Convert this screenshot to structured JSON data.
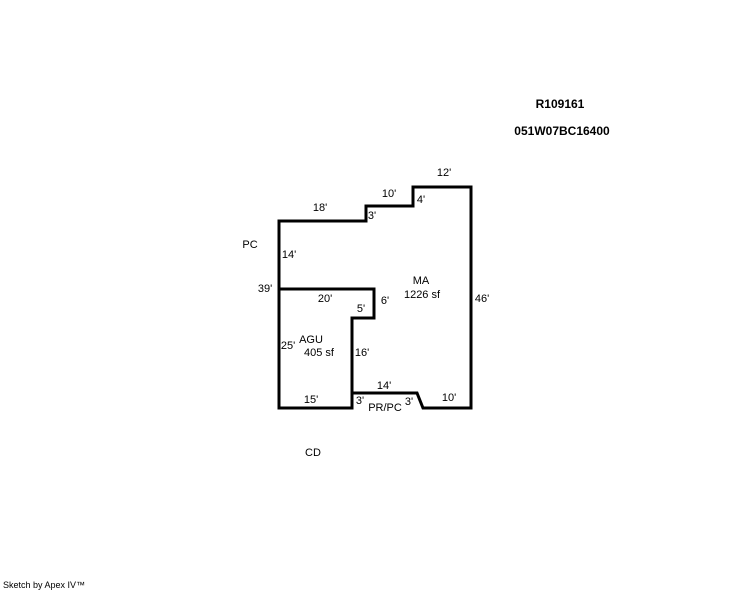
{
  "header": {
    "record_id": "R109161",
    "parcel_id": "051W07BC16400"
  },
  "footer": {
    "branding": "Sketch by Apex IV™"
  },
  "sketch": {
    "areas": [
      {
        "code": "MA",
        "size": "1226 sf"
      },
      {
        "code": "AGU",
        "size": "405 sf"
      }
    ],
    "zone_labels": {
      "pc": "PC",
      "prpc": "PR/PC",
      "cd": "CD"
    },
    "dimensions": {
      "top_12": "12'",
      "top_10": "10'",
      "top_4": "4'",
      "top_18": "18'",
      "top_3": "3'",
      "left_14": "14'",
      "left_39": "39'",
      "left_25": "25'",
      "right_46": "46'",
      "mid_20": "20'",
      "mid_6": "6'",
      "mid_5": "5'",
      "mid_16": "16'",
      "bottom_14": "14'",
      "bottom_15": "15'",
      "bottom_3_left": "3'",
      "bottom_3_right": "3'",
      "bottom_10": "10'"
    }
  },
  "geometry": {
    "stroke_color": "#000000",
    "stroke_width": 3,
    "outer_points": "279,221 366,221 366,206 413,206 413,187 471,187 471,408 423,408 417,393 352,393 352,408 279,408",
    "partition_points": "279,289 374,289 374,318 352,318 352,393"
  }
}
